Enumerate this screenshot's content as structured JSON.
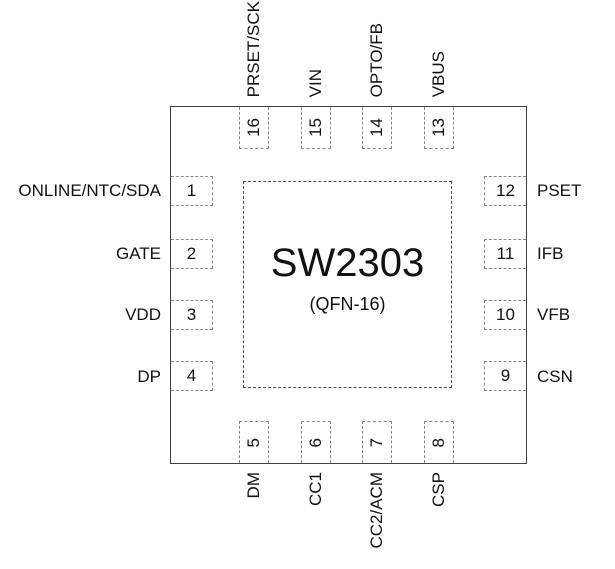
{
  "chip": {
    "name": "SW2303",
    "package": "(QFN-16)"
  },
  "pins": {
    "left": [
      {
        "number": "1",
        "label": "ONLINE/NTC/SDA"
      },
      {
        "number": "2",
        "label": "GATE"
      },
      {
        "number": "3",
        "label": "VDD"
      },
      {
        "number": "4",
        "label": "DP"
      }
    ],
    "bottom": [
      {
        "number": "5",
        "label": "DM"
      },
      {
        "number": "6",
        "label": "CC1"
      },
      {
        "number": "7",
        "label": "CC2/ACM"
      },
      {
        "number": "8",
        "label": "CSP"
      }
    ],
    "right": [
      {
        "number": "9",
        "label": "CSN"
      },
      {
        "number": "10",
        "label": "VFB"
      },
      {
        "number": "11",
        "label": "IFB"
      },
      {
        "number": "12",
        "label": "PSET"
      }
    ],
    "top": [
      {
        "number": "13",
        "label": "VBUS"
      },
      {
        "number": "14",
        "label": "OPTO/FB"
      },
      {
        "number": "15",
        "label": "VIN"
      },
      {
        "number": "16",
        "label": "PRSET/SCK"
      }
    ]
  },
  "colors": {
    "background": "#ffffff",
    "chip_border": "#404040",
    "pin_dash": "#888888",
    "pad_dash": "#4d4d4d",
    "text": "#111111"
  }
}
